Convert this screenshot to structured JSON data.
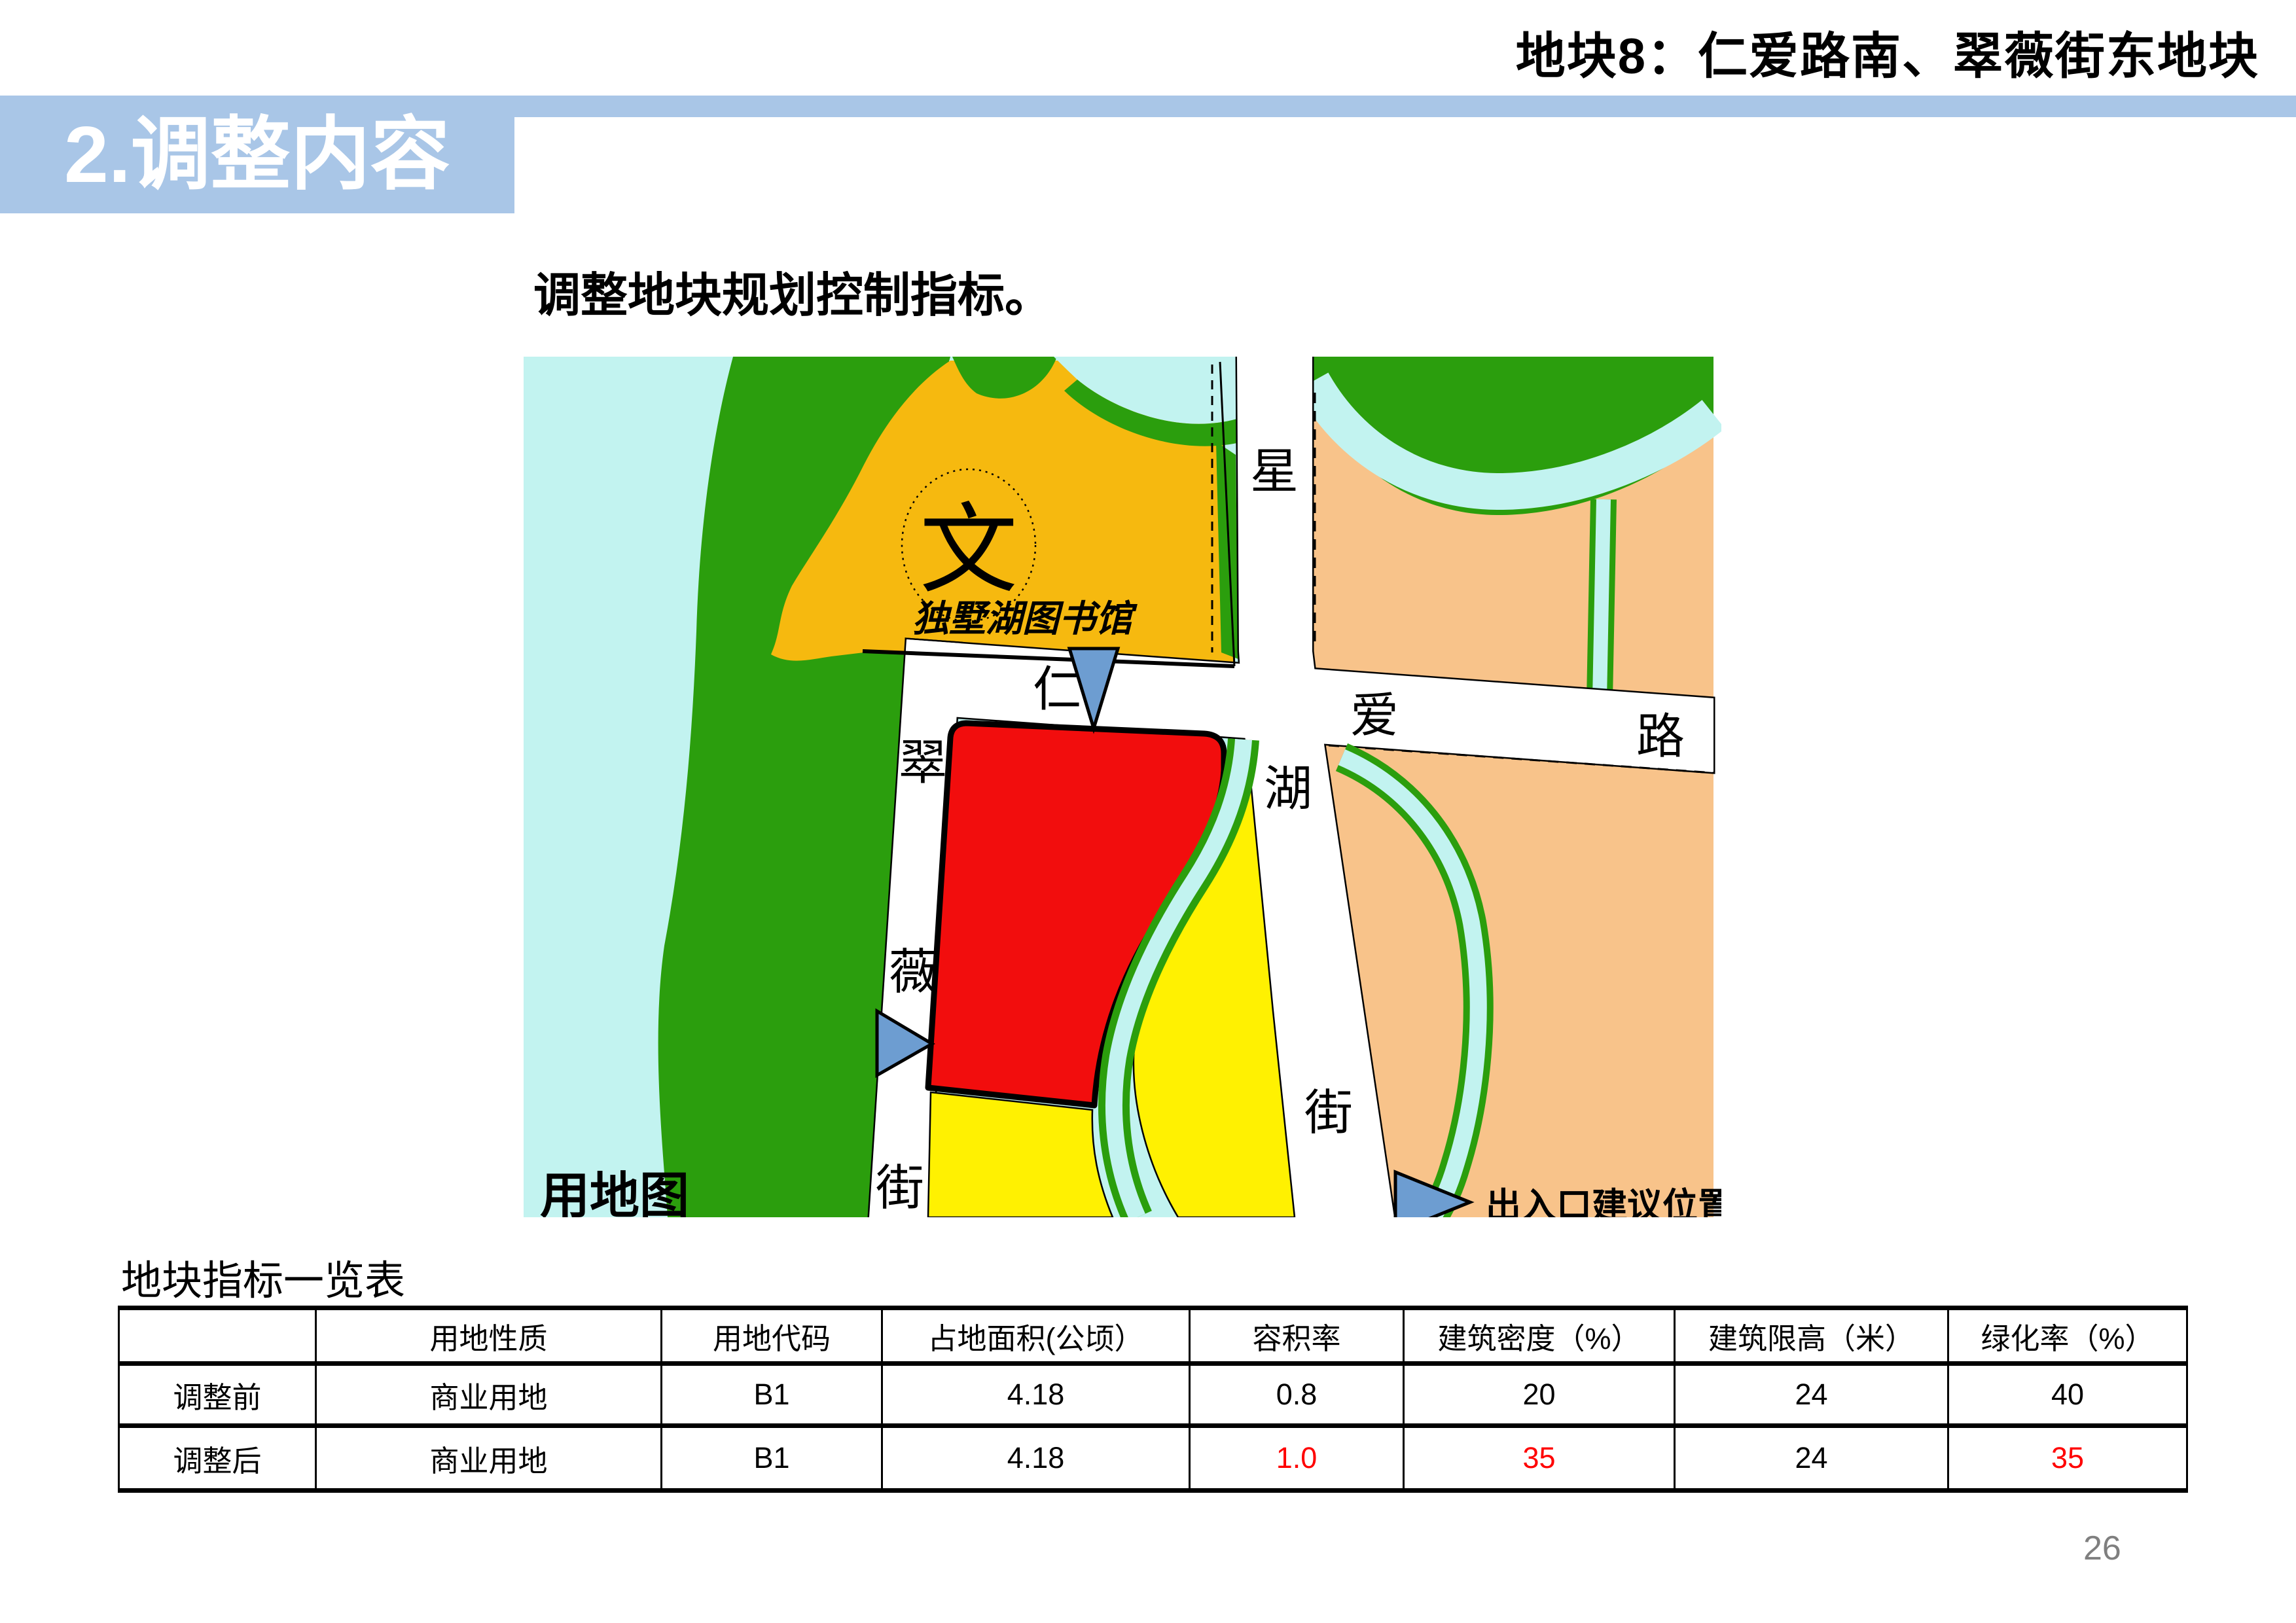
{
  "slide": {
    "header_title": "地块8：仁爱路南、翠薇街东地块",
    "banner_label": "2.调整内容",
    "subtitle": "调整地块规划控制指标。",
    "page_number": "26",
    "banner_color": "#A9C6E7"
  },
  "map": {
    "caption": "用地图",
    "entrance_note": "出入口建议位置",
    "landmark": {
      "symbol": "文",
      "name": "独墅湖图书馆"
    },
    "roads": {
      "renai": [
        "仁",
        "爱",
        "路"
      ],
      "xinghu": [
        "星",
        "湖",
        "街"
      ],
      "cuiwei": [
        "翠",
        "薇",
        "街"
      ]
    },
    "colors": {
      "water": "#C2F3F0",
      "park_green": "#2B9E0D",
      "library_orange": "#F6B90F",
      "residential_peach": "#F8C38A",
      "plot_red": "#F20D0D",
      "plot_yellow": "#FFF101",
      "marker_blue": "#6D9DD1",
      "road_white": "#FFFFFF"
    }
  },
  "table": {
    "title": "地块指标一览表",
    "headers": [
      "",
      "用地性质",
      "用地代码",
      "占地面积(公顷）",
      "容积率",
      "建筑密度（%）",
      "建筑限高（米）",
      "绿化率（%）"
    ],
    "rows": [
      {
        "label": "调整前",
        "cells": [
          "商业用地",
          "B1",
          "4.18",
          "0.8",
          "20",
          "24",
          "40"
        ],
        "red_cols": []
      },
      {
        "label": "调整后",
        "cells": [
          "商业用地",
          "B1",
          "4.18",
          "1.0",
          "35",
          "24",
          "35"
        ],
        "red_cols": [
          3,
          4,
          6
        ]
      }
    ],
    "highlight_color": "#FF0000"
  }
}
